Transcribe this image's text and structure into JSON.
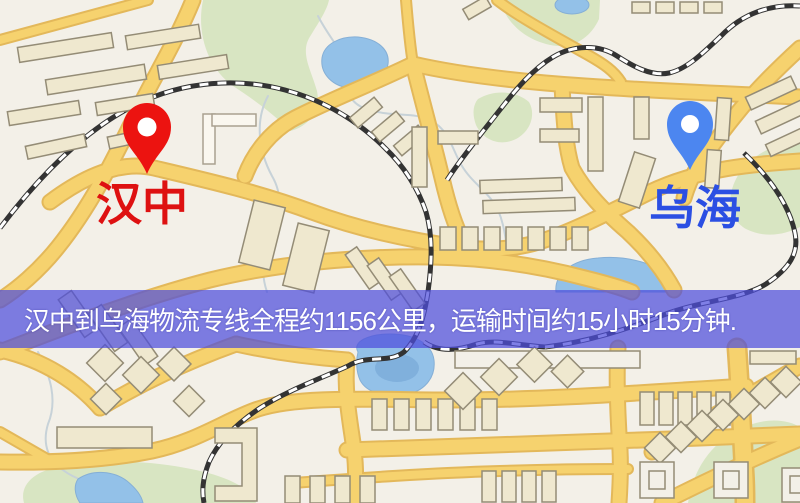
{
  "map": {
    "origin": {
      "label": "汉中",
      "pin_color": "#EC1310",
      "label_color": "#DE1111"
    },
    "destination": {
      "label": "乌海",
      "pin_color": "#4C86F0",
      "label_color": "#2B4FE3"
    },
    "palette": {
      "land": "#F3F0E8",
      "road": "#F6D26E",
      "road_casing": "#E3B85A",
      "building": "#EFE8CF",
      "building_outline": "#948C76",
      "park": "#D8E5C2",
      "water": "#93C1E8",
      "railway": "#333333",
      "river": "#C7D2D8"
    }
  },
  "banner": {
    "text": "汉中到乌海物流专线全程约1156公里，运输时间约15小时15分钟.",
    "background": "rgba(77,78,221,0.72)",
    "text_color": "#FFFFFF"
  }
}
